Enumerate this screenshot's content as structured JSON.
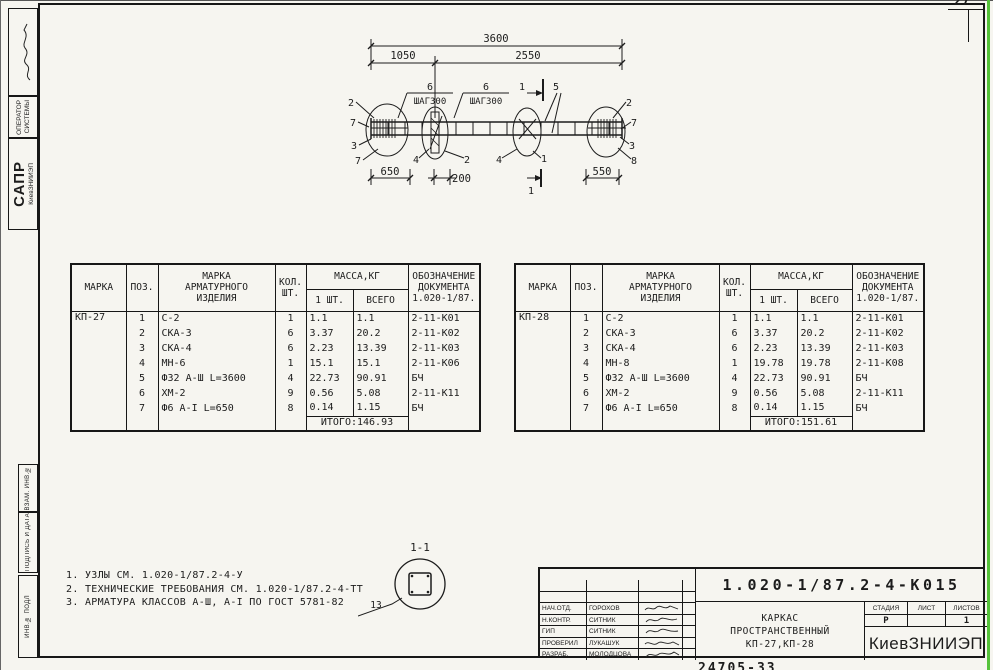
{
  "page": {
    "sheet_corner": "27",
    "bottom_stamp": "24705-33"
  },
  "colors": {
    "ink": "#1c1c1c",
    "paper": "#f6f5f0",
    "edge_green": "#55c23a"
  },
  "margin": {
    "developer": "МОЛОДЦОВА",
    "operator_line1": "ОПЕРАТОР",
    "operator_line2": "СИСТЕМЫ",
    "sapr": "САПР",
    "sapr_org": "КиевЗНИИЭП",
    "vzam": "ВЗАМ. ИНВ.№",
    "podpis": "ПОДПИСЬ И ДАТА",
    "inv": "ИНВ.№ ПОДЛ"
  },
  "drawing": {
    "dim_overall": "3600",
    "dim_left": "1050",
    "dim_right": "2550",
    "dim_650": "650",
    "dim_200": "200",
    "dim_550": "550",
    "step_count_1": "6",
    "step_label_1": "ШАГ300",
    "step_count_2": "6",
    "step_label_2": "ШАГ300",
    "section_mark": "1",
    "pos_5": "5",
    "pos_left": [
      "2",
      "7",
      "3",
      "7"
    ],
    "pos_bottom": [
      "4",
      "2",
      "4",
      "1"
    ],
    "pos_right": [
      "2",
      "7",
      "3",
      "8"
    ]
  },
  "section_detail": {
    "title": "1-1",
    "pos": "13"
  },
  "notes": [
    "1. УЗЛЫ СМ. 1.020-1/87.2-4-У",
    "2. ТЕХНИЧЕСКИЕ ТРЕБОВАНИЯ СМ. 1.020-1/87.2-4-ТТ",
    "3. АРМАТУРА КЛАССОВ А-Ш, А-I ПО ГОСТ 5781-82"
  ],
  "table_header": {
    "mark": "МАРКА",
    "pos": "ПОЗ.",
    "item": "МАРКА\nАРМАТУРНОГО\nИЗДЕЛИЯ",
    "qty": "КОЛ.\nШТ.",
    "mass": "МАССА,КГ",
    "mass_one": "1 ШТ.",
    "mass_all": "ВСЕГО",
    "doc": "ОБОЗНАЧЕНИЕ\nДОКУМЕНТА\n1.020-1/87."
  },
  "tables": [
    {
      "mark": "КП-27",
      "rows": [
        [
          "1",
          "С-2",
          "1",
          "1.1",
          "1.1",
          "2-11-К01"
        ],
        [
          "2",
          "СКА-3",
          "6",
          "3.37",
          "20.2",
          "2-11-К02"
        ],
        [
          "3",
          "СКА-4",
          "6",
          "2.23",
          "13.39",
          "2-11-К03"
        ],
        [
          "4",
          "МН-6",
          "1",
          "15.1",
          "15.1",
          "2-11-К06"
        ],
        [
          "5",
          "Ф32 А-Ш L=3600",
          "4",
          "22.73",
          "90.91",
          "БЧ"
        ],
        [
          "6",
          "ХМ-2",
          "9",
          "0.56",
          "5.08",
          "2-11-К11"
        ],
        [
          "7",
          "Ф6 А-I L=650",
          "8",
          "0.14",
          "1.15",
          "БЧ"
        ]
      ],
      "total": "ИТОГО:146.93"
    },
    {
      "mark": "КП-28",
      "rows": [
        [
          "1",
          "С-2",
          "1",
          "1.1",
          "1.1",
          "2-11-К01"
        ],
        [
          "2",
          "СКА-3",
          "6",
          "3.37",
          "20.2",
          "2-11-К02"
        ],
        [
          "3",
          "СКА-4",
          "6",
          "2.23",
          "13.39",
          "2-11-К03"
        ],
        [
          "4",
          "МН-8",
          "1",
          "19.78",
          "19.78",
          "2-11-К08"
        ],
        [
          "5",
          "Ф32 А-Ш L=3600",
          "4",
          "22.73",
          "90.91",
          "БЧ"
        ],
        [
          "6",
          "ХМ-2",
          "9",
          "0.56",
          "5.08",
          "2-11-К11"
        ],
        [
          "7",
          "Ф6 А-I L=650",
          "8",
          "0.14",
          "1.15",
          "БЧ"
        ]
      ],
      "total": "ИТОГО:151.61"
    }
  ],
  "title_block": {
    "doc_number": "1.020-1/87.2-4-К015",
    "signers": [
      {
        "role": "НАЧ.ОТД.",
        "name": "ГОРОХОВ"
      },
      {
        "role": "Н.КОНТР.",
        "name": "СИТНИК"
      },
      {
        "role": "ГИП",
        "name": "СИТНИК"
      },
      {
        "role": "ПРОВЕРИЛ",
        "name": "ЛУКАШУК"
      },
      {
        "role": "РАЗРАБ.",
        "name": "МОЛОДЦОВА"
      }
    ],
    "title_line1": "КАРКАС",
    "title_line2": "ПРОСТРАНСТВЕННЫЙ",
    "title_line3": "КП-27,КП-28",
    "stage_label": "СТАДИЯ",
    "sheet_label": "ЛИСТ",
    "sheets_label": "ЛИСТОВ",
    "stage_value": "Р",
    "sheets_value": "1",
    "org": "КиевЗНИИЭП"
  }
}
